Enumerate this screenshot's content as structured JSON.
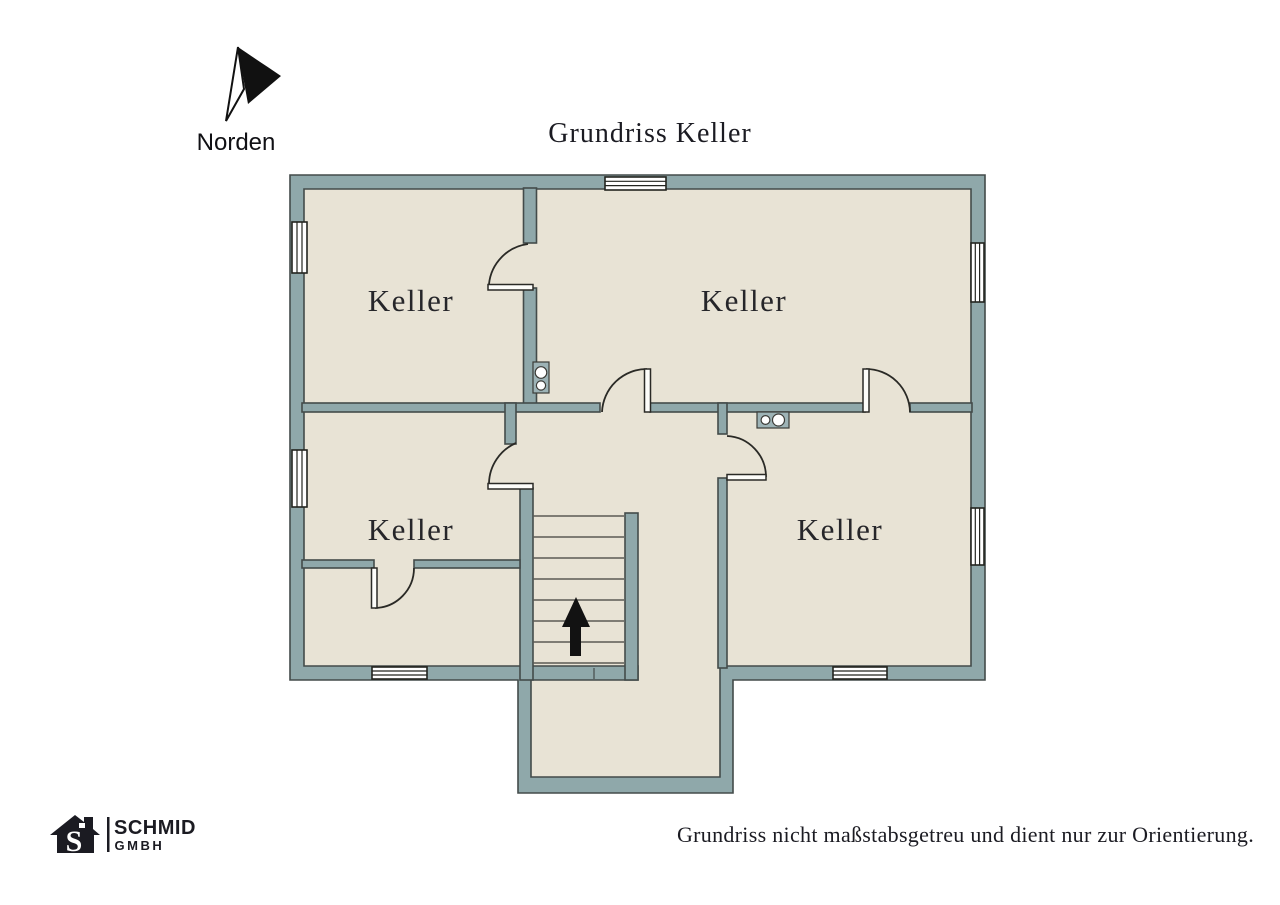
{
  "title": "Grundriss Keller",
  "compass": {
    "label": "Norden",
    "direction": "north"
  },
  "rooms": [
    {
      "label": "Keller",
      "position": "top-left"
    },
    {
      "label": "Keller",
      "position": "top-right"
    },
    {
      "label": "Keller",
      "position": "bottom-left"
    },
    {
      "label": "Keller",
      "position": "bottom-right"
    }
  ],
  "stairs": {
    "direction_arrow": "up"
  },
  "footer": {
    "logo": {
      "monogram": "S",
      "company": "SCHMID",
      "suffix": "GMBH"
    },
    "disclaimer": "Grundriss nicht maßstabsgetreu und dient nur zur Orientierung."
  },
  "colors": {
    "wall": "#8FA8AA",
    "floor": "#E8E3D5",
    "outline": "#434B4A",
    "ink": "#1B1B22",
    "fixture": "#9DB3B6"
  }
}
